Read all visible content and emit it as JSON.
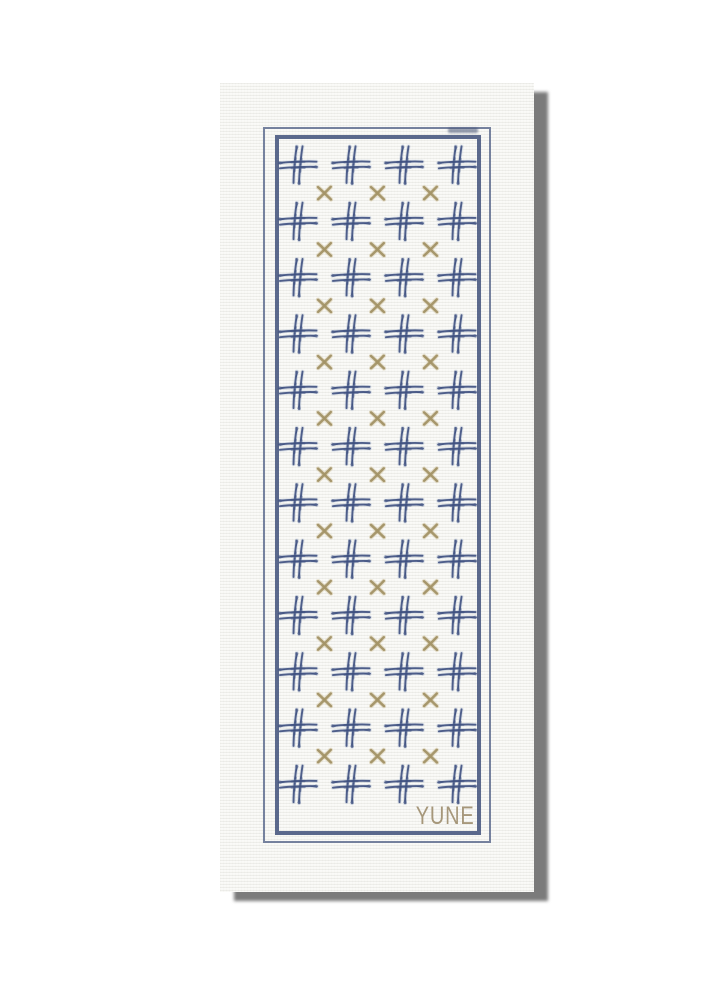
{
  "scene": {
    "description": "Product photo of a rolled-out yoga mat on a white background with a hard gray drop shadow",
    "brand": "YUNE"
  },
  "colors": {
    "page_background": "#ffffff",
    "mat_background": "#f9f9f6",
    "shadow_gray": "#7b7b7b",
    "border_navy": "rgba(64,80,122,0.85)",
    "border_navy_light": "rgba(82,97,134,0.78)",
    "hash_navy": "#3e5080",
    "hash_halo": "#8fa0c0",
    "x_tan": "#a39367",
    "x_halo": "#cdbf97",
    "brand_tan": "#a6977a"
  },
  "pattern": {
    "hash_motif": {
      "cols": 4,
      "rows": 12,
      "origin_x": 78,
      "origin_y": 82,
      "step_x": 53,
      "step_y": 56.3
    },
    "x_motif": {
      "cols": 3,
      "rows": 11,
      "origin_x": 104.5,
      "origin_y": 110.2,
      "step_x": 53,
      "step_y": 56.3
    }
  }
}
